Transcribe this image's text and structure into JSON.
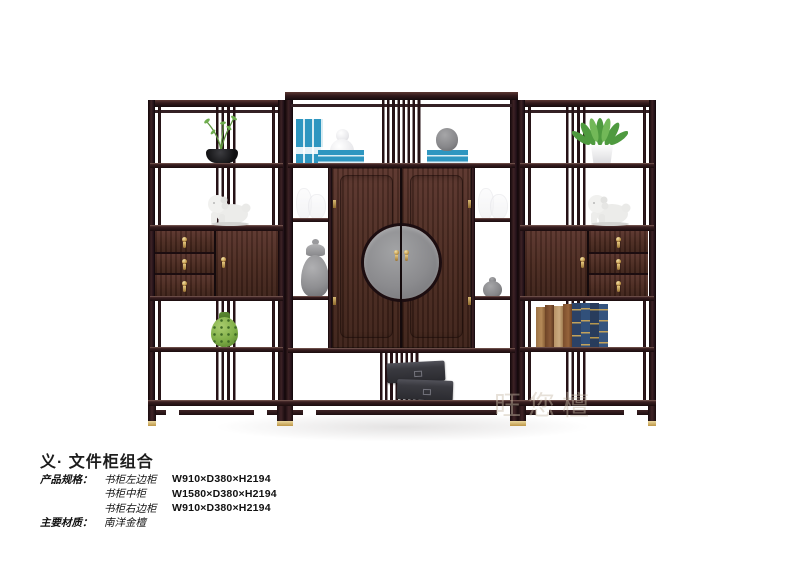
{
  "page": {
    "background": "#ffffff"
  },
  "photo": {
    "watermark": "旺您檀",
    "colors": {
      "wood": "#42231f",
      "brass": "#c9a55b",
      "metal_plate": "#8b8b8e",
      "book_teal": "#2e96c0",
      "plant_green": "#4e9a3f"
    },
    "decor": {
      "left_unit": [
        "potted-plant",
        "lion-figurine",
        "green-porcelain-vase"
      ],
      "middle_unit": [
        "blue-books",
        "white-gourd-vase",
        "gray-jar",
        "crystal-vases",
        "gray-temple-jar",
        "small-gray-vase",
        "black-boxes"
      ],
      "right_unit": [
        "potted-plant",
        "lion-figurine",
        "book-row"
      ]
    }
  },
  "product": {
    "title": "义· 文件柜组合",
    "specs_label": "产品规格：",
    "specs": [
      {
        "name": "书柜左边柜",
        "dims": "W910×D380×H2194"
      },
      {
        "name": "书柜中柜",
        "dims": "W1580×D380×H2194"
      },
      {
        "name": "书柜右边柜",
        "dims": "W910×D380×H2194"
      }
    ],
    "material_label": "主要材质：",
    "material_value": "南洋金檀"
  }
}
